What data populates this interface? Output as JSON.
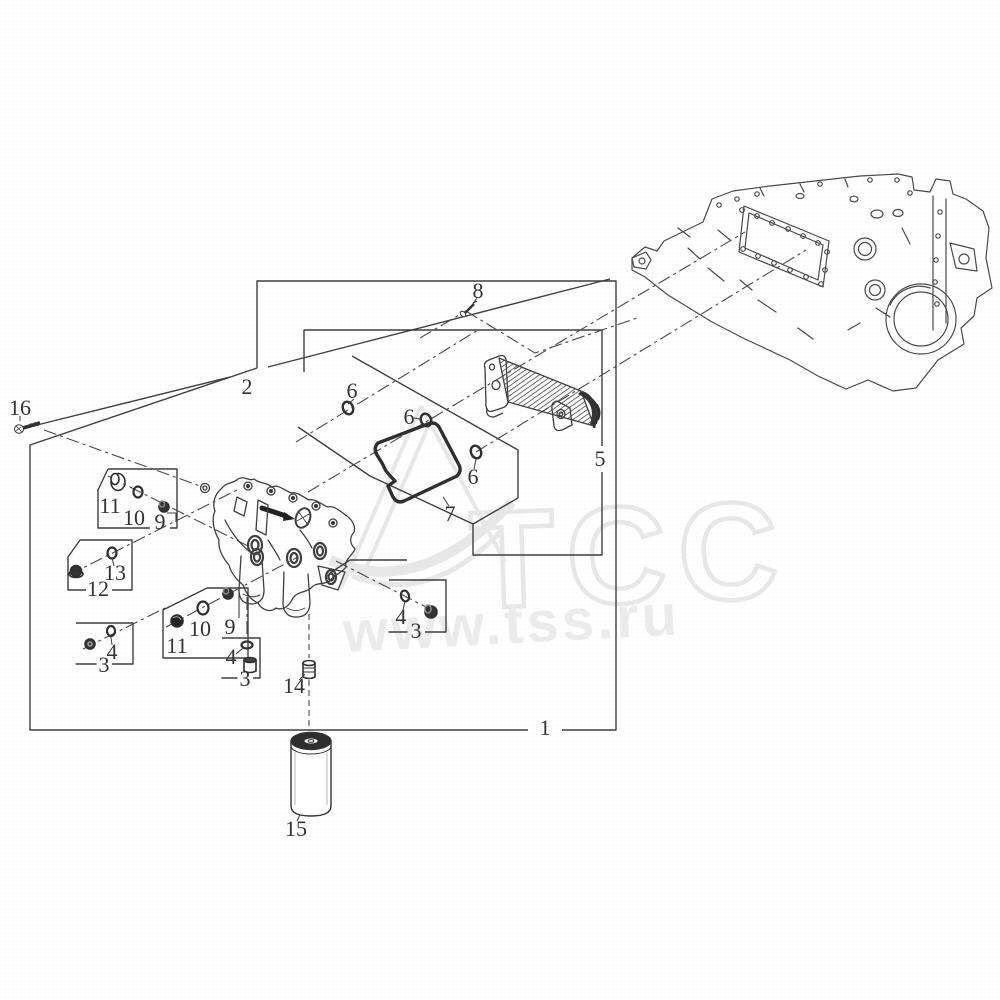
{
  "watermark": {
    "logo_text": "ТСС",
    "site_text": "www.tss.ru"
  },
  "colors": {
    "line": "#404040",
    "label": "#333333",
    "watermark": "#e9e9e9"
  },
  "callouts": [
    {
      "label": "16",
      "x": 20,
      "y": 408
    },
    {
      "label": "2",
      "x": 247,
      "y": 387
    },
    {
      "label": "8",
      "x": 478,
      "y": 291
    },
    {
      "label": "6",
      "x": 352,
      "y": 391
    },
    {
      "label": "6",
      "x": 409,
      "y": 417
    },
    {
      "label": "6",
      "x": 473,
      "y": 477
    },
    {
      "label": "7",
      "x": 450,
      "y": 514
    },
    {
      "label": "5",
      "x": 600,
      "y": 459
    },
    {
      "label": "11",
      "x": 110,
      "y": 506
    },
    {
      "label": "10",
      "x": 134,
      "y": 518
    },
    {
      "label": "9",
      "x": 160,
      "y": 522
    },
    {
      "label": "13",
      "x": 115,
      "y": 573
    },
    {
      "label": "12",
      "x": 98,
      "y": 589
    },
    {
      "label": "4",
      "x": 112,
      "y": 652
    },
    {
      "label": "3",
      "x": 104,
      "y": 665
    },
    {
      "label": "11",
      "x": 177,
      "y": 646
    },
    {
      "label": "10",
      "x": 200,
      "y": 629
    },
    {
      "label": "9",
      "x": 230,
      "y": 627
    },
    {
      "label": "4",
      "x": 231,
      "y": 657
    },
    {
      "label": "3",
      "x": 245,
      "y": 679
    },
    {
      "label": "4",
      "x": 401,
      "y": 617
    },
    {
      "label": "3",
      "x": 416,
      "y": 631
    },
    {
      "label": "14",
      "x": 294,
      "y": 686
    },
    {
      "label": "15",
      "x": 296,
      "y": 829
    },
    {
      "label": "1",
      "x": 545,
      "y": 728
    }
  ]
}
